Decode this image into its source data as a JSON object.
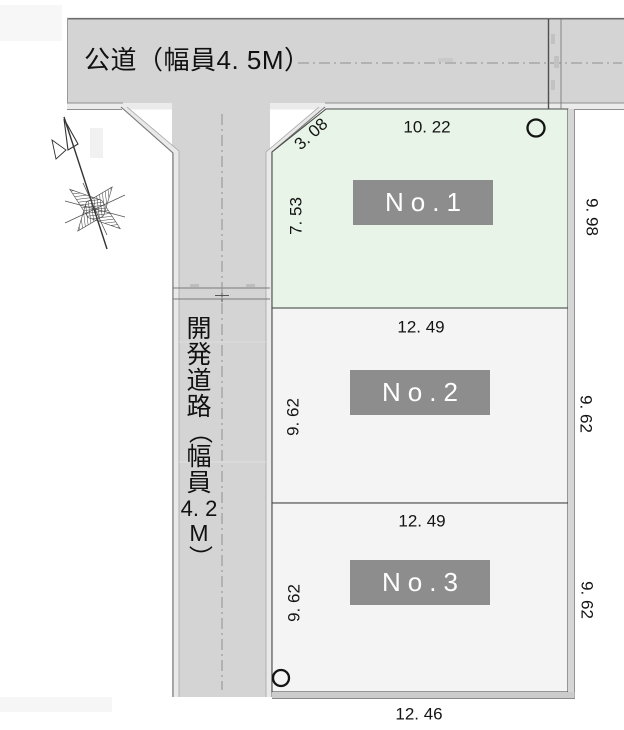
{
  "diagram": {
    "public_road": {
      "label": "公道（幅員4. 5M）"
    },
    "dev_road": {
      "label": "開発道路（幅員4.2M）",
      "chars": [
        "開",
        "発",
        "道",
        "路",
        "（",
        "幅",
        "員",
        "4. 2",
        "M",
        "）"
      ]
    },
    "lots": [
      {
        "label": "No.1",
        "top": "10. 22",
        "top_left": "3. 08",
        "left": "7. 53",
        "right": "9. 98"
      },
      {
        "label": "No.2",
        "top": "12. 49",
        "left": "9. 62",
        "right": "9. 62"
      },
      {
        "label": "No.3",
        "top": "12. 49",
        "left": "9. 62",
        "right": "9. 62",
        "bottom": "12. 46"
      }
    ],
    "markers": {
      "survey_circles": [
        "lot1-top-right",
        "lot3-bottom-left"
      ]
    },
    "colors": {
      "road_fill": "#d4d4d4",
      "road_edge_strip": "#ebebeb",
      "lot1_fill": "#e8f4e8",
      "lot_fill": "#f4f4f4",
      "lot_border": "#4a4a4a",
      "label_box": "#8d8d8d",
      "label_text": "#ffffff",
      "centerline": "#909090"
    }
  }
}
